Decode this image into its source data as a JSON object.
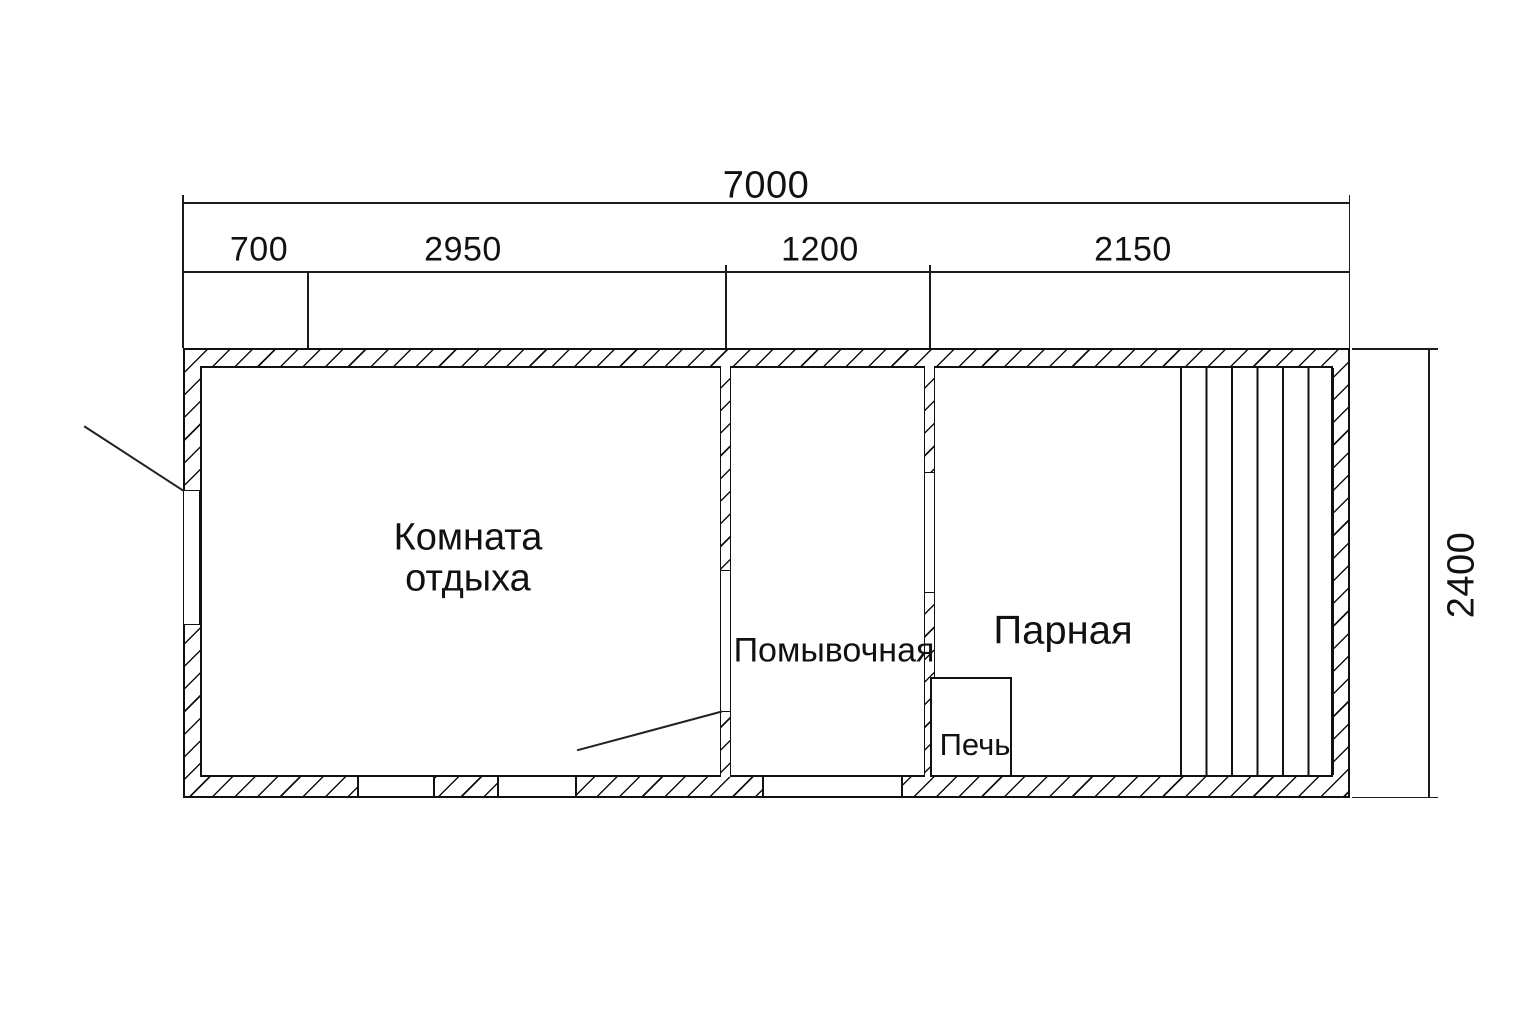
{
  "meta": {
    "type": "bathhouse floor plan",
    "language": "ru"
  },
  "dimensions": {
    "total_width": "7000",
    "segments": [
      {
        "label": "700"
      },
      {
        "label": "2950"
      },
      {
        "label": "1200"
      },
      {
        "label": "2150"
      }
    ],
    "height": "2400"
  },
  "rooms": {
    "rest": {
      "name_line1": "Комната",
      "name_line2": "отдыха"
    },
    "wash": {
      "name": "Помывочная"
    },
    "steam": {
      "name": "Парная"
    },
    "stove": {
      "name": "Печь"
    }
  },
  "colors": {
    "line": "#111111",
    "background": "#ffffff"
  }
}
